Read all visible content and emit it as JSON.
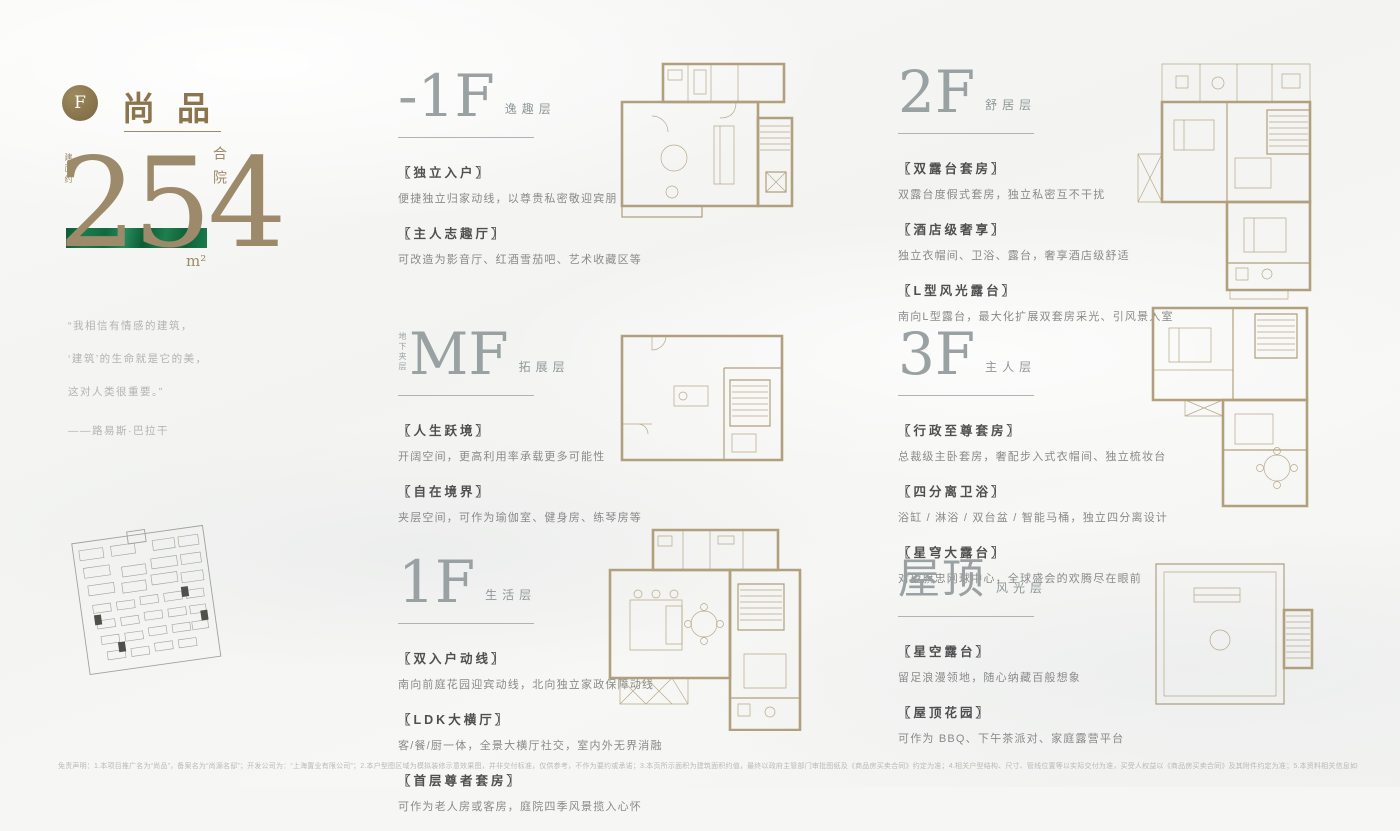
{
  "colors": {
    "accent_gold": "#8C744C",
    "bronze": "#9C8A6A",
    "band_green": "#187647",
    "plan_line": "#B1A07E",
    "header_gray": "#99A1A3"
  },
  "brand": {
    "badge": "F",
    "title": "尚品",
    "area_label": "建面约",
    "area_value": "254",
    "area_unit": "m²",
    "type_label": "合院"
  },
  "quote": {
    "line1": "“我相信有情感的建筑，",
    "line2": "‘建筑’的生命就是它的美，",
    "line3": "这对人类很重要。”",
    "author": "——路易斯·巴拉干"
  },
  "sections": [
    {
      "floor": "-1F",
      "name": "逸趣层",
      "side_label": "",
      "features": [
        {
          "title": "〖独立入户〗",
          "desc": "便捷独立归家动线，以尊贵私密敬迎宾朋"
        },
        {
          "title": "〖主人志趣厅〗",
          "desc": "可改造为影音厅、红酒雪茄吧、艺术收藏区等"
        }
      ]
    },
    {
      "floor": "MF",
      "name": "拓展层",
      "side_label": "地下夹层",
      "features": [
        {
          "title": "〖人生跃境〗",
          "desc": "开阔空间，更高利用率承载更多可能性"
        },
        {
          "title": "〖自在境界〗",
          "desc": "夹层空间，可作为瑜伽室、健身房、练琴房等"
        }
      ]
    },
    {
      "floor": "1F",
      "name": "生活层",
      "side_label": "",
      "features": [
        {
          "title": "〖双入户动线〗",
          "desc": "南向前庭花园迎宾动线，北向独立家政保障动线"
        },
        {
          "title": "〖LDK大横厅〗",
          "desc": "客/餐/厨一体，全景大横厅社交，室内外无界消融"
        },
        {
          "title": "〖首层尊者套房〗",
          "desc": "可作为老人房或客房，庭院四季风景揽入心怀"
        }
      ]
    },
    {
      "floor": "2F",
      "name": "舒居层",
      "side_label": "",
      "features": [
        {
          "title": "〖双露台套房〗",
          "desc": "双露台度假式套房，独立私密互不干扰"
        },
        {
          "title": "〖酒店级奢享〗",
          "desc": "独立衣帽间、卫浴、露台，奢享酒店级舒适"
        },
        {
          "title": "〖L型风光露台〗",
          "desc": "南向L型露台，最大化扩展双套房采光、引风景入室"
        }
      ]
    },
    {
      "floor": "3F",
      "name": "主人层",
      "side_label": "",
      "features": [
        {
          "title": "〖行政至尊套房〗",
          "desc": "总裁级主卧套房，奢配步入式衣帽间、独立梳妆台"
        },
        {
          "title": "〖四分离卫浴〗",
          "desc": "浴缸 / 淋浴 / 双台盆 / 智能马桶，独立四分离设计"
        },
        {
          "title": "〖星穹大露台〗",
          "desc": "对望旗忠网球中心，全球盛会的欢腾尽在眼前"
        }
      ]
    },
    {
      "floor": "屋顶",
      "name": "风光层",
      "side_label": "",
      "features": [
        {
          "title": "〖星空露台〗",
          "desc": "留足浪漫领地，随心纳藏百般想象"
        },
        {
          "title": "〖屋顶花园〗",
          "desc": "可作为 BBQ、下午茶派对、家庭露营平台"
        }
      ]
    }
  ],
  "footer": {
    "disclaimer": "免责声明：1.本项目推广名为“尚品”，备案名为“尚源名邸”；开发公司为：“上海置业有限公司”；2.本户型图区域为模拟装修示意效果图，并非交付标准，仅供参考，不作为要约或承诺；3.本页所示面积为建筑面积约值，最终以政府主管部门审批图纸及《商品房买卖合同》约定为准；4.相关户型结构、尺寸、管线位置等以实际交付为准，买受人权益以《商品房买卖合同》及其附件约定为准；5.本资料相关信息如有变动，敬请留意最新资料；资料制作时间：2025年7月。"
  }
}
